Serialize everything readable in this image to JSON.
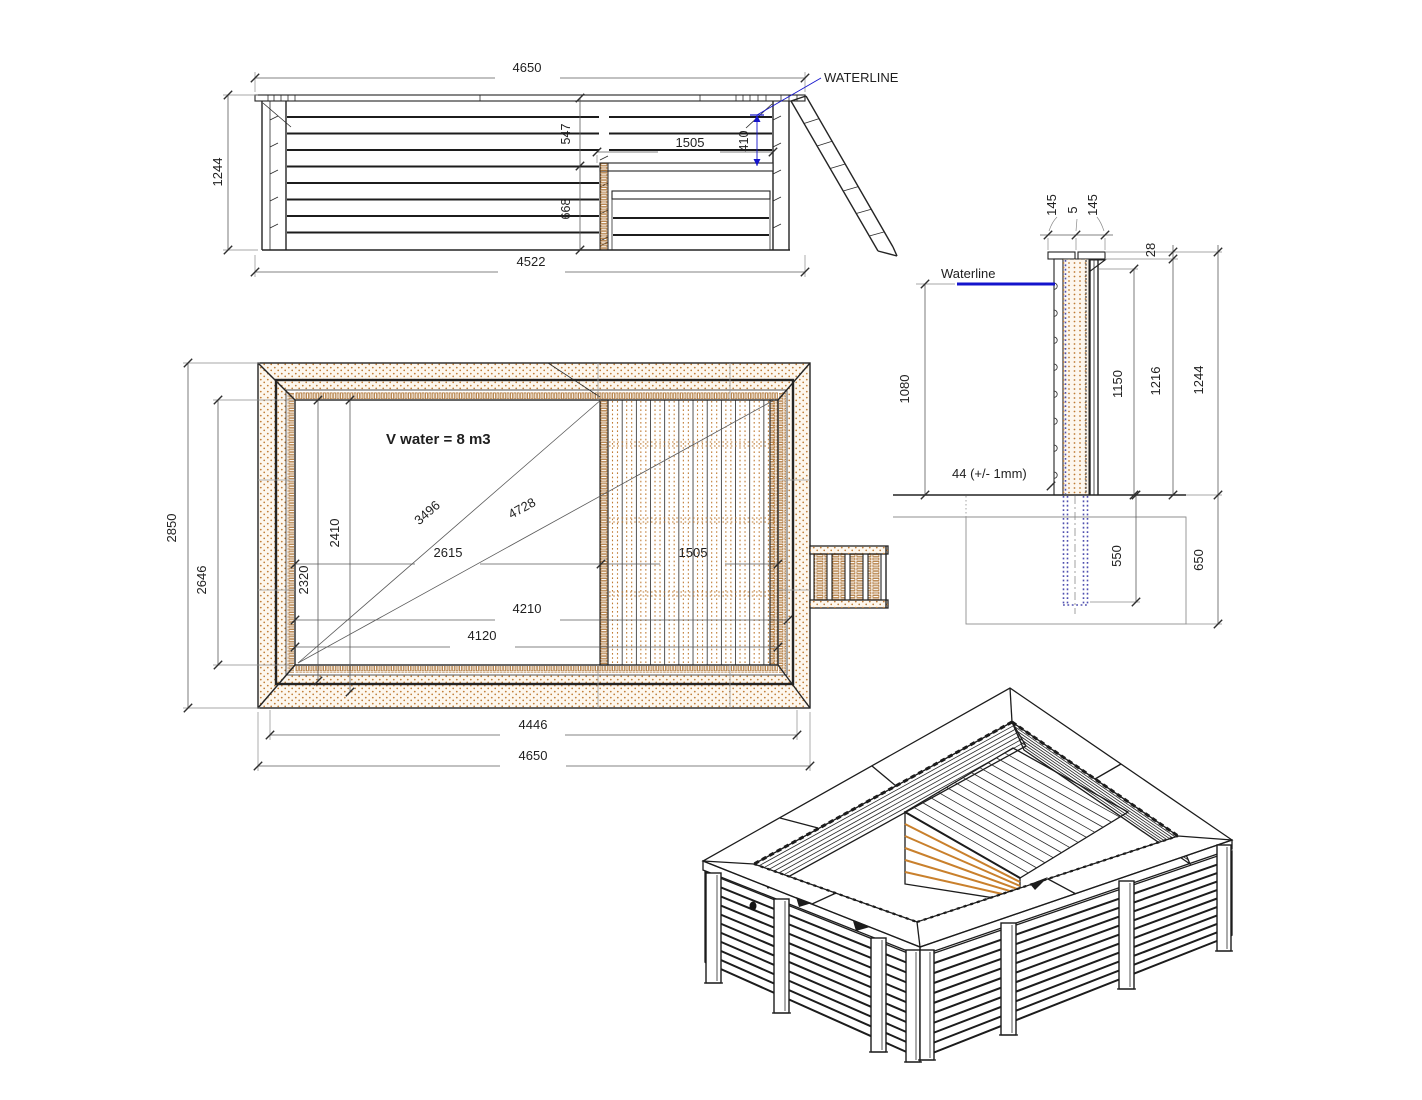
{
  "drawing_title": "Wooden pool technical drawing",
  "colors": {
    "waterline_blue": "#1414cc",
    "wood_dot": "#bf7c35",
    "line_dark": "#242424"
  },
  "elevation": {
    "waterline_label": "WATERLINE",
    "dim_top_width": "4650",
    "dim_height": "1244",
    "dim_top_to_seat": "547",
    "dim_seat_length": "1505",
    "dim_waterline_to_seat": "410",
    "dim_seat_height": "668",
    "dim_base_width": "4522"
  },
  "plan": {
    "volume_label": "V water = 8 m3",
    "dim_outer_width": "2850",
    "dim_inner_width": "2646",
    "dim_2410": "2410",
    "dim_2320": "2320",
    "dim_diag_short": "3496",
    "dim_diag_long": "4728",
    "dim_left_to_bench": "2615",
    "dim_bench_length": "1505",
    "dim_4210": "4210",
    "dim_4120": "4120",
    "dim_inner_length": "4446",
    "dim_outer_length": "4650"
  },
  "section": {
    "waterline_label": "Waterline",
    "dim_cap_outer": "145",
    "dim_cap_gap": "5",
    "dim_cap_inner": "145",
    "dim_cap_thickness": "28",
    "dim_water_depth": "1080",
    "dim_inner_height": "1150",
    "dim_wall_height": "1216",
    "dim_total_height": "1244",
    "plank_thickness_label": "44 (+/- 1mm)",
    "dim_anchor_depth": "550",
    "dim_foundation_depth": "650"
  }
}
